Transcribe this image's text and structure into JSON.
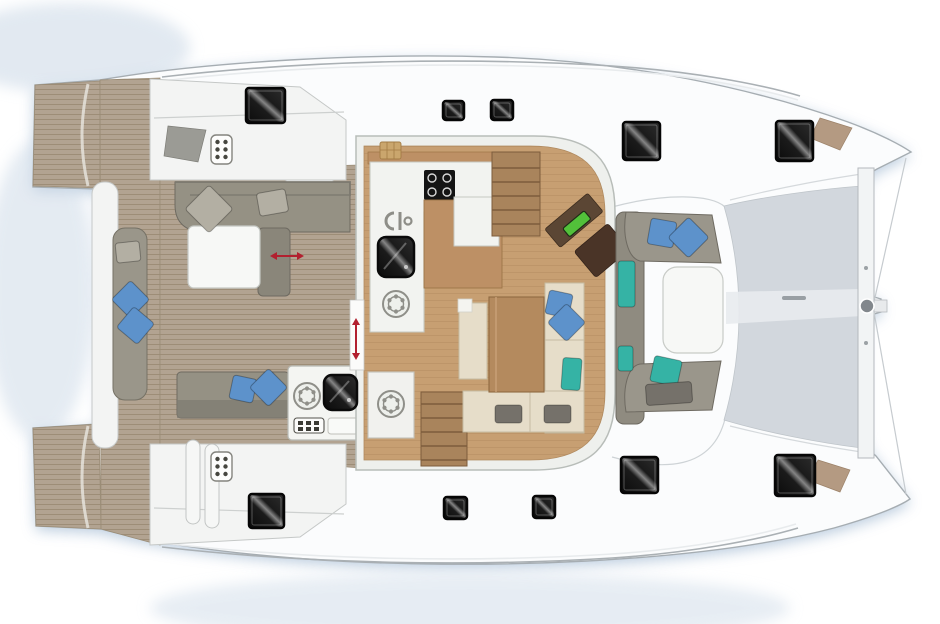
{
  "meta": {
    "title": "catamaran-deck-and-saloon-floor-plan",
    "view": "top-down",
    "orientation": "bow-right"
  },
  "palette": {
    "background": "#ffffff",
    "shadow_blue": "#aec2d8",
    "hull_white": "#fbfcfd",
    "hull_outline": "#a6adb2",
    "teak": "#b2a391",
    "teak_stripe": "#95866e",
    "wood_floor": "#c79f72",
    "wood_stair": "#a9845c",
    "wood_table": "#b48a5e",
    "island_wood": "#bd9065",
    "sofa_light": "#9a968b",
    "sofa_mid": "#8f8b80",
    "sofa_dark": "#6e6a61",
    "bench_beige": "#e6ddc9",
    "white_furniture": "#f4f5f2",
    "trampoline": "#d2d7dd",
    "hatch_black": "#0b0b0b",
    "nav_desk_brown": "#5b4634",
    "instrument_green": "#52c13a",
    "arrow_red": "#b2202f",
    "tan_patch": "#b49a82",
    "pillow_colors": {
      "blue": "#5d92cb",
      "teal": "#35b3a5",
      "gray_light": "#b3afa3",
      "gray_dark": "#75716a"
    }
  },
  "areas": [
    {
      "name": "swim-platform-starboard"
    },
    {
      "name": "swim-platform-port"
    },
    {
      "name": "transom-walkway"
    },
    {
      "name": "aft-cockpit"
    },
    {
      "name": "cockpit-table"
    },
    {
      "name": "wet-bar"
    },
    {
      "name": "saloon"
    },
    {
      "name": "galley"
    },
    {
      "name": "galley-island"
    },
    {
      "name": "nav-station"
    },
    {
      "name": "dining-area"
    },
    {
      "name": "stairs-starboard-hull"
    },
    {
      "name": "stairs-port-hull"
    },
    {
      "name": "forward-cockpit"
    },
    {
      "name": "forward-cockpit-table"
    },
    {
      "name": "trampoline"
    },
    {
      "name": "forward-crossbeam"
    },
    {
      "name": "bowsprit"
    }
  ],
  "hatches": [
    {
      "id": "stb-aft",
      "x": 246,
      "y": 88,
      "w": 39,
      "h": 35
    },
    {
      "id": "stb-mid-1",
      "x": 443,
      "y": 101,
      "w": 21,
      "h": 19
    },
    {
      "id": "stb-mid-2",
      "x": 491,
      "y": 100,
      "w": 22,
      "h": 20
    },
    {
      "id": "stb-fwd",
      "x": 623,
      "y": 122,
      "w": 37,
      "h": 38
    },
    {
      "id": "stb-bow",
      "x": 776,
      "y": 121,
      "w": 37,
      "h": 40
    },
    {
      "id": "port-aft",
      "x": 249,
      "y": 494,
      "w": 35,
      "h": 34
    },
    {
      "id": "port-mid-1",
      "x": 444,
      "y": 497,
      "w": 23,
      "h": 22
    },
    {
      "id": "port-mid-2",
      "x": 533,
      "y": 496,
      "w": 22,
      "h": 22
    },
    {
      "id": "port-fwd",
      "x": 621,
      "y": 457,
      "w": 37,
      "h": 36
    },
    {
      "id": "port-bow",
      "x": 775,
      "y": 455,
      "w": 40,
      "h": 41
    }
  ],
  "pillows": [
    {
      "x": 192,
      "y": 192,
      "w": 34,
      "h": 34,
      "rot": 45,
      "color": "gray_light"
    },
    {
      "x": 258,
      "y": 191,
      "w": 29,
      "h": 23,
      "rot": -10,
      "color": "gray_light"
    },
    {
      "x": 116,
      "y": 242,
      "w": 24,
      "h": 20,
      "rot": -6,
      "color": "gray_light"
    },
    {
      "x": 117,
      "y": 286,
      "w": 27,
      "h": 27,
      "rot": 45,
      "color": "blue"
    },
    {
      "x": 122,
      "y": 312,
      "w": 27,
      "h": 27,
      "rot": 40,
      "color": "blue"
    },
    {
      "x": 231,
      "y": 377,
      "w": 24,
      "h": 24,
      "rot": 12,
      "color": "blue"
    },
    {
      "x": 255,
      "y": 374,
      "w": 27,
      "h": 27,
      "rot": 45,
      "color": "blue"
    },
    {
      "x": 547,
      "y": 292,
      "w": 24,
      "h": 24,
      "rot": 12,
      "color": "blue"
    },
    {
      "x": 553,
      "y": 309,
      "w": 27,
      "h": 27,
      "rot": 45,
      "color": "blue"
    },
    {
      "x": 562,
      "y": 358,
      "w": 19,
      "h": 32,
      "rot": 4,
      "color": "teal"
    },
    {
      "x": 495,
      "y": 405,
      "w": 27,
      "h": 18,
      "rot": 0,
      "color": "gray_dark"
    },
    {
      "x": 544,
      "y": 405,
      "w": 27,
      "h": 18,
      "rot": 0,
      "color": "gray_dark"
    },
    {
      "x": 649,
      "y": 220,
      "w": 26,
      "h": 26,
      "rot": 10,
      "color": "blue"
    },
    {
      "x": 674,
      "y": 223,
      "w": 29,
      "h": 29,
      "rot": 45,
      "color": "blue"
    },
    {
      "x": 618,
      "y": 261,
      "w": 17,
      "h": 46,
      "rot": 0,
      "color": "teal"
    },
    {
      "x": 618,
      "y": 346,
      "w": 15,
      "h": 25,
      "rot": 0,
      "color": "teal"
    },
    {
      "x": 652,
      "y": 358,
      "w": 28,
      "h": 26,
      "rot": 12,
      "color": "teal"
    },
    {
      "x": 646,
      "y": 383,
      "w": 46,
      "h": 21,
      "rot": -4,
      "color": "gray_dark"
    }
  ],
  "vent_panels": [
    {
      "x": 211,
      "y": 135
    },
    {
      "x": 211,
      "y": 452
    }
  ],
  "ring_burner_icons": [
    {
      "x": 396,
      "y": 304
    },
    {
      "x": 307,
      "y": 396
    },
    {
      "x": 391,
      "y": 404
    }
  ],
  "sinks": [
    {
      "x": 378,
      "y": 237,
      "w": 36,
      "h": 40
    },
    {
      "x": 324,
      "y": 375,
      "w": 33,
      "h": 35
    }
  ],
  "cooktop": {
    "x": 424,
    "y": 170,
    "w": 31,
    "h": 30,
    "burners": 4
  },
  "door_arrows": [
    {
      "x1": 276,
      "y1": 256,
      "x2": 298,
      "y2": 256
    },
    {
      "x1": 356,
      "y1": 324,
      "x2": 356,
      "y2": 354
    }
  ],
  "icons": [
    "deck-hatch",
    "vent-grid-icon",
    "ring-burner-icon",
    "sink-icon",
    "cooktop-icon",
    "faucet-icon",
    "icebox-icon",
    "control-panel-icon",
    "bowsprit-ring-icon",
    "door-slide-arrow"
  ]
}
